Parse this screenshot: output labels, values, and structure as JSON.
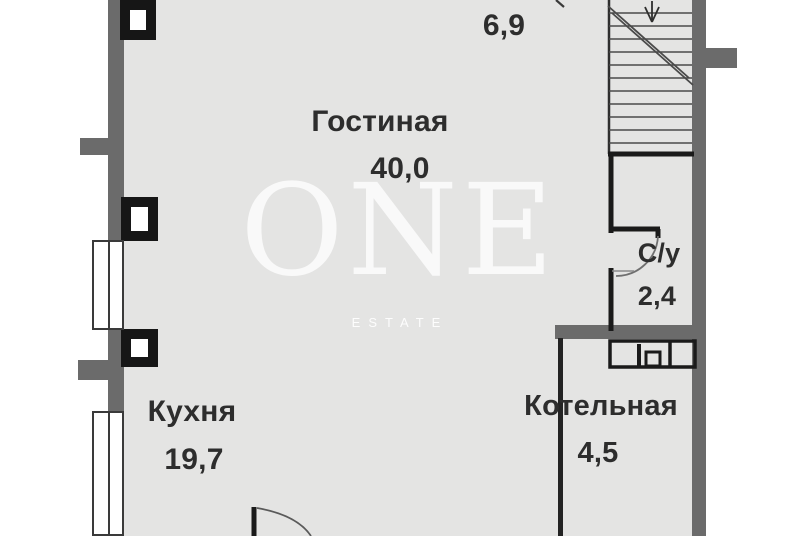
{
  "watermark": {
    "brand": "ONE",
    "subtitle": "ESTATE"
  },
  "rooms": {
    "living": {
      "name": "Гостиная",
      "area": "40,0"
    },
    "hall": {
      "area": "6,9"
    },
    "kitchen": {
      "name": "Кухня",
      "area": "19,7"
    },
    "bathroom": {
      "name": "С/у",
      "area": "2,4"
    },
    "boiler": {
      "name": "Котельная",
      "area": "4,5"
    }
  },
  "colors": {
    "floor": "#e4e4e3",
    "wall_gray": "#6b6b6b",
    "structure_black": "#161616",
    "label_text": "#2d2d2d",
    "watermark": "#f5f5f3"
  }
}
